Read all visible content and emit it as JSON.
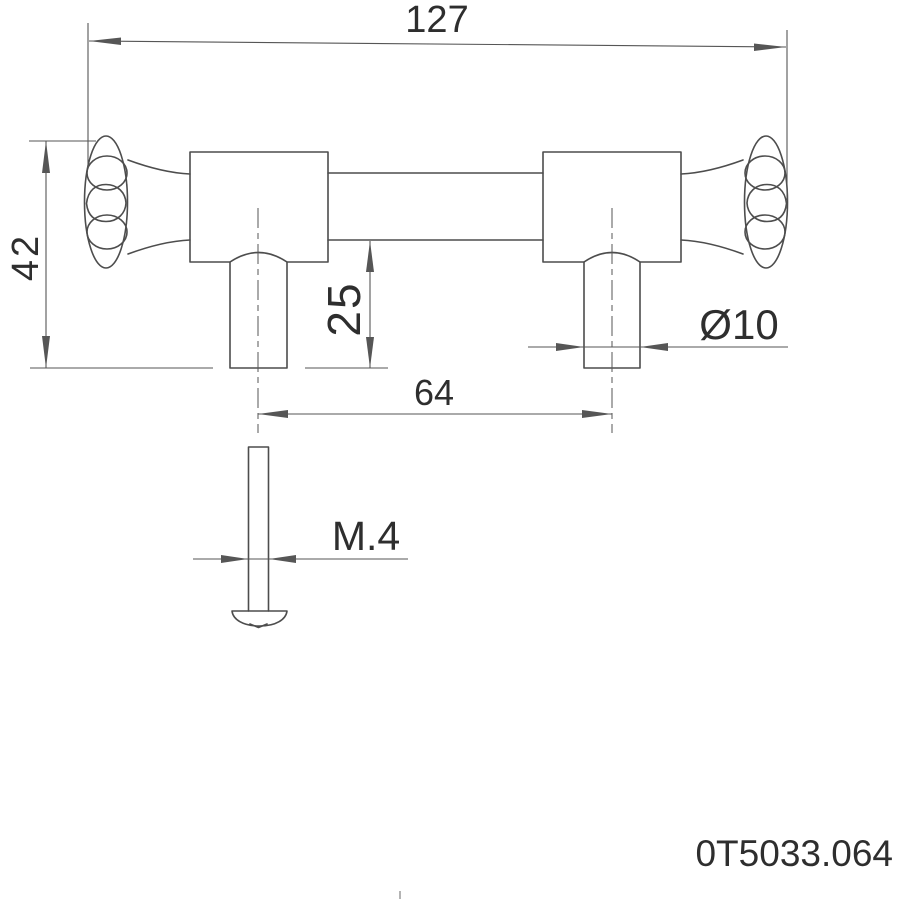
{
  "drawing": {
    "kind": "technical dimension drawing of a cabinet pull handle with mounting screw",
    "part_number": "0T5033.064",
    "dimensions": {
      "overall_length": "127",
      "overall_height": "42",
      "post_height": "25",
      "hole_centers": "64",
      "post_diameter": "Ø10",
      "screw_thread": "M.4"
    },
    "colors": {
      "background": "#ffffff",
      "line": "#4d4d4d",
      "dim_line": "#565656",
      "text": "#2e2e2e"
    }
  }
}
